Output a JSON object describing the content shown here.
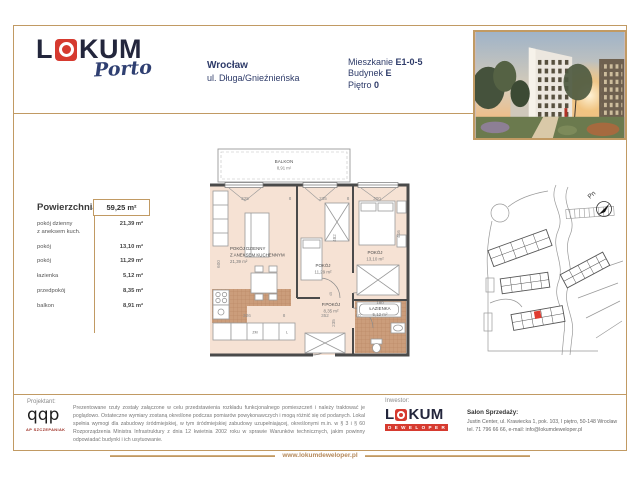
{
  "header": {
    "logo": {
      "l": "L",
      "kum": "KUM",
      "sub": "Porto"
    },
    "city": "Wrocław",
    "street": "ul. Długa/Gnieźnieńska",
    "unit": {
      "label_apartment": "Mieszkanie",
      "apartment": "E1-0-5",
      "label_building": "Budynek",
      "building": "E",
      "label_floor": "Piętro",
      "floor": "0"
    }
  },
  "area_table": {
    "header_label": "Powierzchnia",
    "header_value": "59,25 m²",
    "rows": [
      {
        "label": "pokój dzienny\nz aneksem kuch.",
        "value": "21,39 m²"
      },
      {
        "label": "pokój",
        "value": "13,10 m²"
      },
      {
        "label": "pokój",
        "value": "11,29 m²"
      },
      {
        "label": "łazienka",
        "value": "5,12 m²"
      },
      {
        "label": "przedpokój",
        "value": "8,35 m²"
      },
      {
        "label": "balkon",
        "value": "8,91 m²"
      }
    ]
  },
  "floor_plan": {
    "balcony_label": "BALKON",
    "balcony_area": "8,91 m²",
    "living_1": "POKÓJ DZIENNY",
    "living_2": "Z ANEKSEM KUCHENNYM",
    "living_area": "21,39 m²",
    "room_mid_label": "POKÓJ",
    "room_mid_area": "11,29 m²",
    "room_right_label": "POKÓJ",
    "room_right_area": "13,10 m²",
    "hall_label": "P.POKÓJ",
    "hall_area": "8,35 m²",
    "bath_label": "ŁAZIENKA",
    "bath_area": "5,12 m²",
    "kitchen_zm": "ZM",
    "kitchen_l": "L",
    "dims": {
      "top1": "325",
      "top2": "8",
      "top3": "235",
      "top4": "8",
      "top5": "300",
      "row1": "326",
      "row2": "8",
      "row3": "352",
      "row4": "10",
      "v_left": "600",
      "v_mid": "482",
      "v_right": "416",
      "v_hall": "235",
      "bath": "180",
      "small": "45"
    }
  },
  "site_plan": {
    "compass": "Pn"
  },
  "footer": {
    "designer_label": "Projektant:",
    "designer_logo": {
      "mark": "qqp",
      "name": "AP SZCZEPANIAK"
    },
    "disclaimer": "Prezentowane rzuty zostały załączone w celu przedstawienia rozkładu funkcjonalnego pomieszczeń i należy traktować je poglądowo. Ostateczne wymiary zostaną określone podczas pomiarów powykonawczych i mogą różnić się od podanych. Lokal spełnia wymogi dla zabudowy śródmiejskiej, w tym śródmiejskiej zabudowy uzupełniającej, określonymi m.in. w § 3 i § 60 Rozporządzenia Ministra Infrastruktury z dnia 12 kwietnia 2002 roku w sprawie Warunków technicznych, jakim powinny odpowiadać budynki i ich usytuowanie.",
    "investor_label": "Inwestor:",
    "investor_logo": {
      "l": "L",
      "kum": "KUM",
      "bar": "DEWELOPER"
    },
    "sales": {
      "title": "Salon Sprzedaży:",
      "address": "Justin Center, ul. Krawiecka 1, pok. 103, I piętro, 50-148 Wrocław",
      "contact": "tel. 71 796 66 66, e-mail: info@lokumdeweloper.pl"
    },
    "website": "www.lokumdeweloper.pl"
  },
  "colors": {
    "gold": "#c19a63",
    "navy": "#2e3b69",
    "brand_red": "#d63a2f",
    "floor": "#f6e2d4",
    "tile": "#cb9d7b",
    "highlight_unit": "#e03c31"
  }
}
